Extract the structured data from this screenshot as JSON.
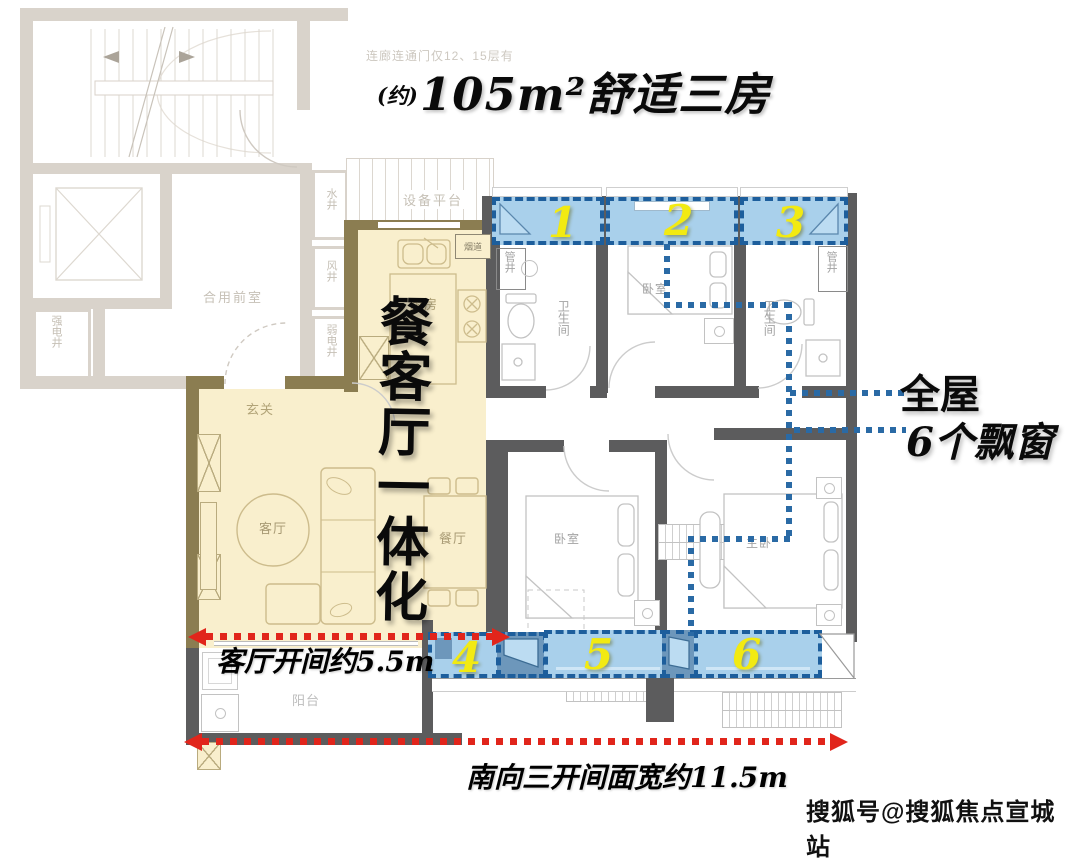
{
  "header": {
    "note": "连廊连通门仅12、15层有",
    "title_prefix": "(约)",
    "title_main": "105m²舒适三房"
  },
  "common": {
    "lobby": "合用前室",
    "strong_elec": "强电井",
    "water": "水井",
    "wind": "风井",
    "weak_elec": "弱电井"
  },
  "rooms": {
    "equipment": "设备平台",
    "flue": "烟道",
    "kitchen": "厨房",
    "foyer": "玄关",
    "living": "客厅",
    "dining": "餐厅",
    "balcony": "阳台",
    "pipe1": "管井",
    "pipe2": "管井",
    "bath1": "卫生间",
    "bath2": "卫生间",
    "bed1": "卧室",
    "bed2": "卧室",
    "master": "主卧"
  },
  "bays": [
    "1",
    "2",
    "3",
    "4",
    "5",
    "6"
  ],
  "annotations": {
    "feature": "餐客厅一体化",
    "whole_house": "全屋",
    "six_bays": "6个飘窗",
    "living_width": "客厅开间约5.5m",
    "south_width": "南向三开间面宽约11.5m"
  },
  "watermark": "搜狐号@搜狐焦点宣城站",
  "colors": {
    "bay_fill": "#a9d0eb",
    "bay_border": "#1d5e9c",
    "highlight_tan": "#f9efcd",
    "wall_dark": "#5c5c5d",
    "wall_olive": "#8b7d51",
    "wall_light": "#d9d3cb",
    "accent_red": "#e1251b",
    "number_yellow": "#f2ea12",
    "callout_blue": "#2a6aa5"
  }
}
